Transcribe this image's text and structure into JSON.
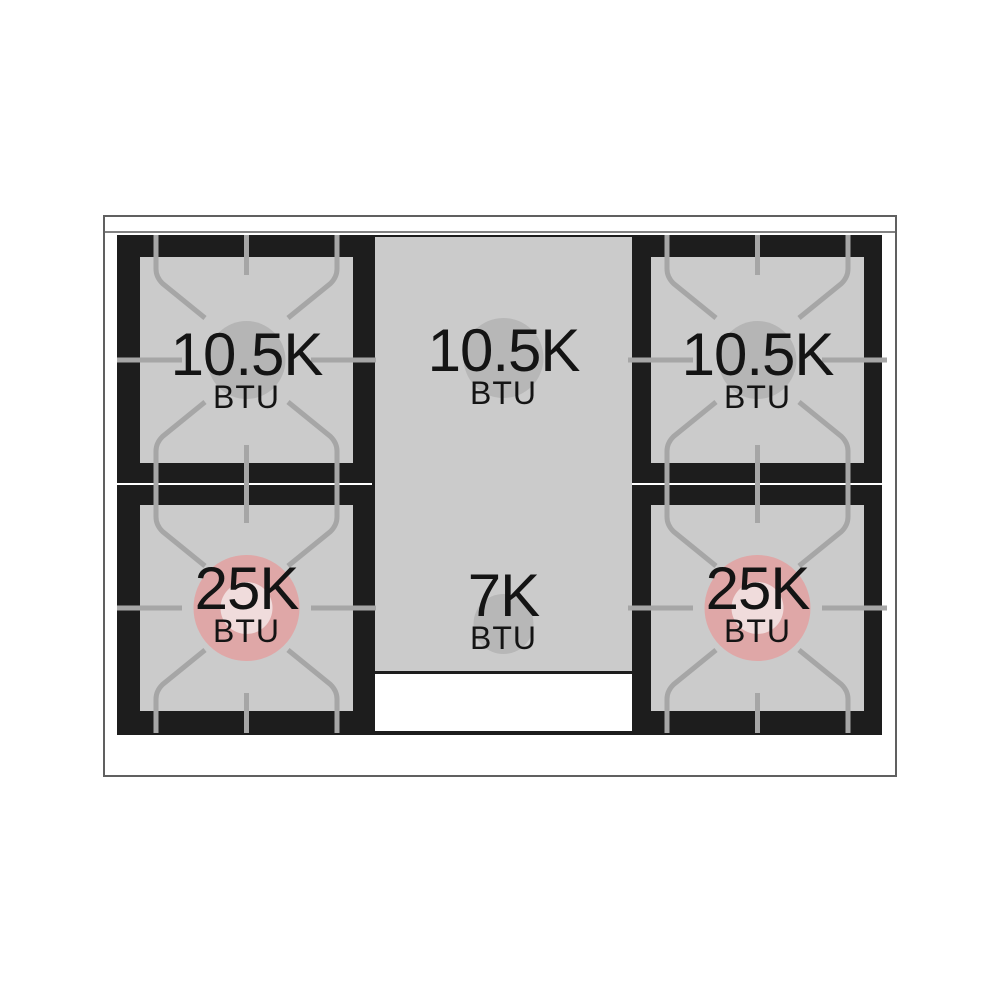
{
  "diagram": {
    "name": "gas-range-cooktop-top-view",
    "description": "Top view diagram of a gas range cooktop with six burner zones and BTU ratings",
    "burners": [
      {
        "position": "back-left",
        "value": "10.5K",
        "unit": "BTU",
        "style": "standard"
      },
      {
        "position": "back-center",
        "value": "10.5K",
        "unit": "BTU",
        "style": "standard"
      },
      {
        "position": "back-right",
        "value": "10.5K",
        "unit": "BTU",
        "style": "standard"
      },
      {
        "position": "front-left",
        "value": "25K",
        "unit": "BTU",
        "style": "dual-ring-highlight"
      },
      {
        "position": "front-center",
        "value": "7K",
        "unit": "BTU",
        "style": "standard"
      },
      {
        "position": "front-right",
        "value": "25K",
        "unit": "BTU",
        "style": "dual-ring-highlight"
      }
    ],
    "colors": {
      "background": "#ffffff",
      "frame_outline": "#606060",
      "back_trim_line": "#828282",
      "cooktop_black": "#1d1d1d",
      "burner_area_gray": "#cbcbcb",
      "grate_line_gray": "#a6a6a6",
      "burner_circle_gray": "#b5b5b5",
      "high_btu_burner_pink": "#dfa7a7",
      "high_btu_inner_ring": "#f0dcdc",
      "label_text": "#141414"
    }
  }
}
